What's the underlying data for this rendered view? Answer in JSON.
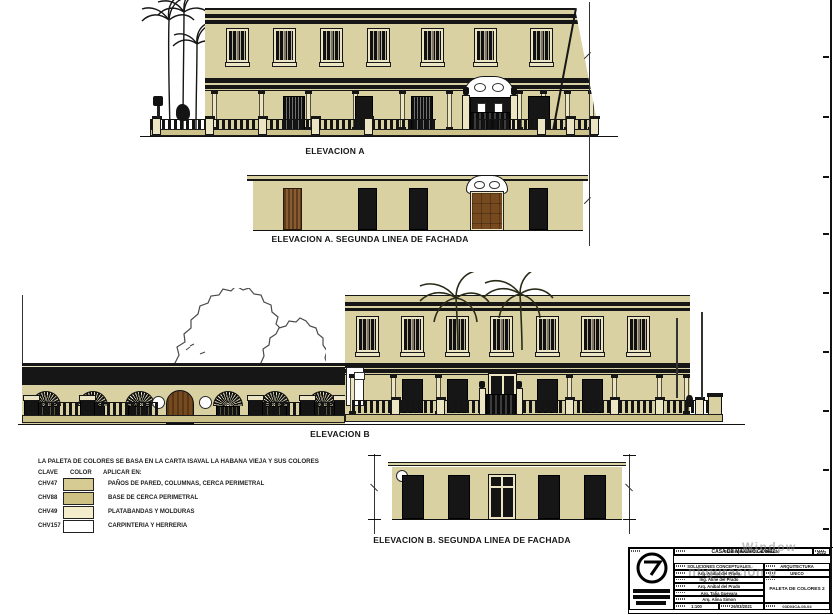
{
  "sheet": {
    "kind": "architectural elevation sheet",
    "bg": "#ffffff"
  },
  "elevations": {
    "a": {
      "label": "ELEVACION A",
      "upper_windows": 7,
      "doors": 5
    },
    "a2": {
      "label": "ELEVACION A. SEGUNDA LINEA DE FACHADA",
      "doors": 5
    },
    "b": {
      "label": "ELEVACION B",
      "upper_windows": 7,
      "arched_windows": 6,
      "doors": 5
    },
    "b2": {
      "label": "ELEVACION B. SEGUNDA LINEA DE FACHADA",
      "doors": 5
    }
  },
  "legend": {
    "title": "LA PALETA DE COLORES SE BASA EN LA CARTA ISAVAL LA HABANA VIEJA Y SUS COLORES",
    "headers": {
      "clave": "CLAVE",
      "color": "COLOR",
      "aplicar": "APLICAR EN:"
    },
    "rows": [
      {
        "code": "CHV47",
        "swatch": "#d6cb93",
        "desc": "PAÑOS DE PARED, COLUMNAS, CERCA PERIMETRAL"
      },
      {
        "code": "CHV88",
        "swatch": "#cdc283",
        "desc": "BASE DE CERCA PERIMETRAL"
      },
      {
        "code": "CHV49",
        "swatch": "#f3edcb",
        "desc": "PLATABANDAS Y MOLDURAS"
      },
      {
        "code": "CHV157",
        "swatch": "#ffffff",
        "desc": "CARPINTERIA Y HERRERIA"
      }
    ]
  },
  "title_block": {
    "project": "CASA DE MAXIMO GOMEZ",
    "year": "2022",
    "address": "5ta Esquina a Ga. B Vedado",
    "phase": "SOLUCIONES CONCEPTUALES",
    "discipline": "ARQUITECTURA",
    "variant": "UNICO",
    "sheet_title": "PALETA DE COLORES 2",
    "team": [
      "Arq. Anibal del Prado",
      "Ing. Aline del Prado",
      "Arq. Anibal del Prado",
      "Arq. Talia Guevara",
      "Arq. Alina Simon"
    ],
    "scale": "1:100",
    "date": "26/03/2021",
    "code": "03D03CA-03-04"
  },
  "watermark": {
    "line1": "Window",
    "line2": "nfiguración p"
  },
  "colors": {
    "wall": "#d9d1a1",
    "base": "#ccc28a",
    "molding": "#ece5c3",
    "line": "#161616",
    "wood": "#76491f",
    "white": "#ffffff"
  }
}
